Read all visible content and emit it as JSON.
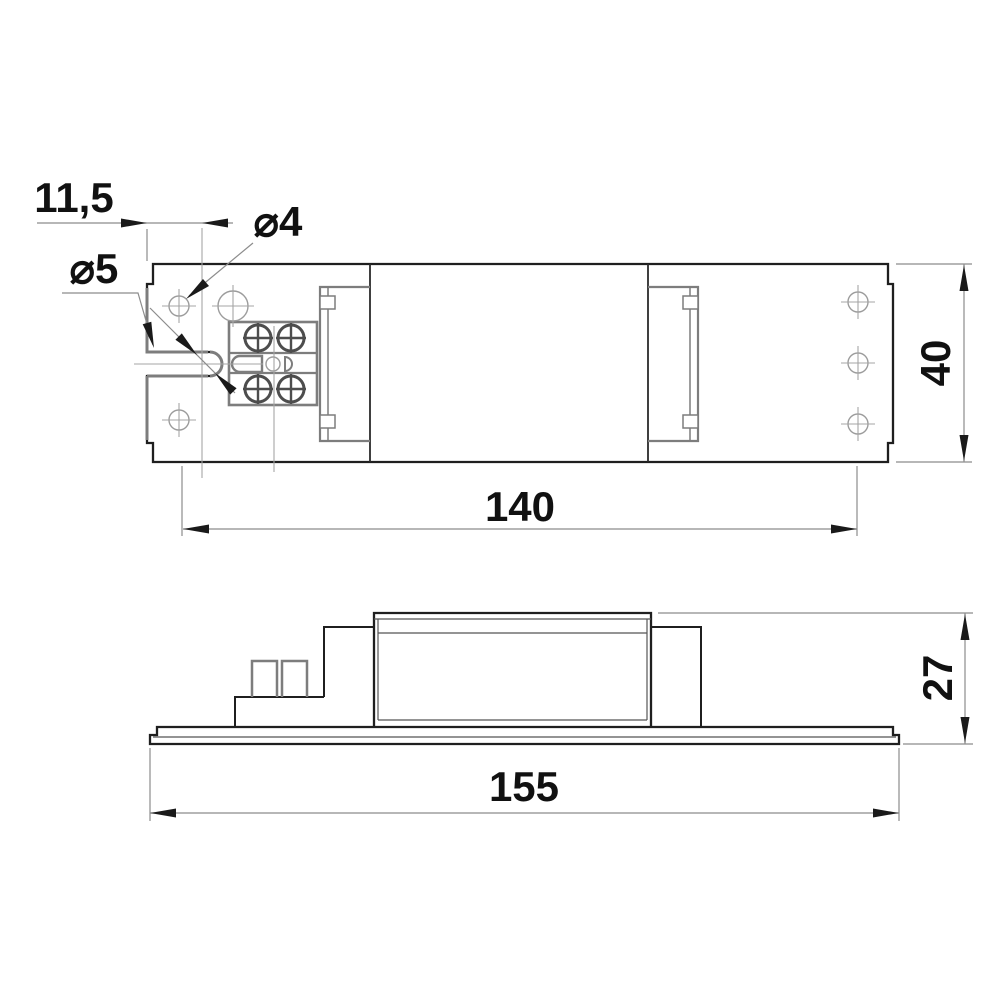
{
  "drawing": {
    "name": "electronic-ballast-dimension-drawing",
    "units": "mm",
    "colors": {
      "outline": "#1f1f1f",
      "secondary_gray": "#7d7d7d",
      "centerline": "#a5a5a5",
      "dimension_line": "#8c8c8c",
      "text": "#111111",
      "background": "#ffffff"
    },
    "dimensions": {
      "offset_left": {
        "label": "11,5",
        "value": 11.5
      },
      "hole_diameter": {
        "label": "⌀4",
        "value": 4
      },
      "slot_diameter": {
        "label": "⌀5",
        "value": 5
      },
      "hole_spacing": {
        "label": "140",
        "value": 140
      },
      "body_width": {
        "label": "40",
        "value": 40
      },
      "base_length": {
        "label": "155",
        "value": 155
      },
      "body_height": {
        "label": "27",
        "value": 27
      }
    }
  }
}
